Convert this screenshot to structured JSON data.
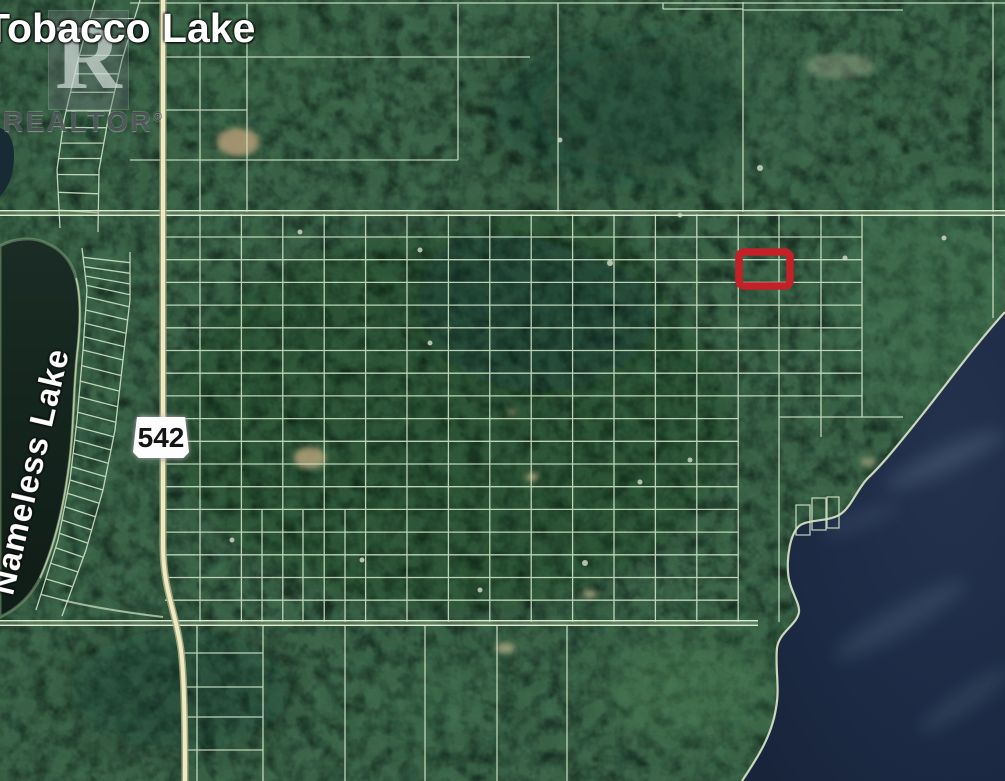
{
  "map": {
    "description": "satellite-parcel-map",
    "labels": {
      "water_top_left": "Tobacco Lake",
      "water_left": "Nameless Lake"
    },
    "highway_shield": {
      "number": "542"
    },
    "watermark": {
      "logo_letter": "R",
      "text": "REALTOR",
      "registered_symbol": "®"
    },
    "highlight": {
      "meaning": "subject-property-outline",
      "color": "#c32128",
      "x": 739,
      "y": 252,
      "width": 51,
      "height": 34
    },
    "colors": {
      "forest": "#2c4c3b",
      "parcel_line": "#cfe3c6",
      "highway_fill": "#efe9c6",
      "large_lake_water": "#1c2a44",
      "nameless_lake_water": "#15251e",
      "shoreline": "#d4dfc2"
    }
  }
}
